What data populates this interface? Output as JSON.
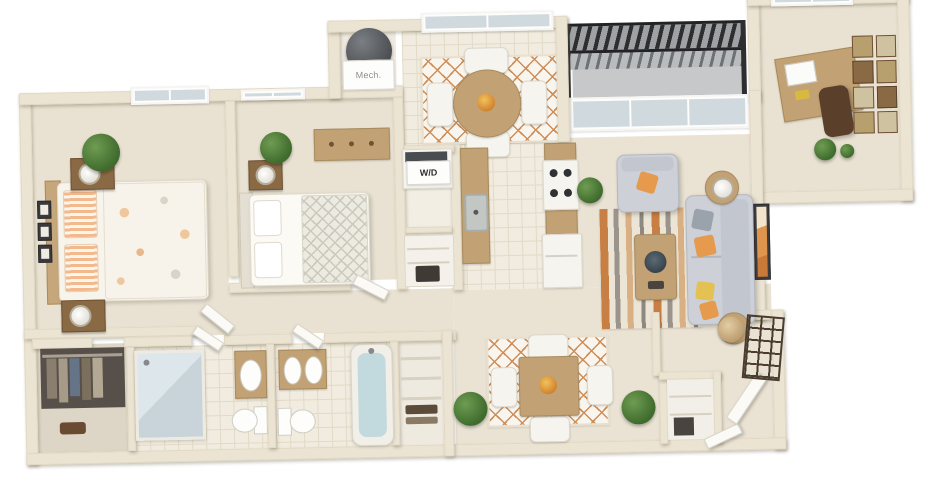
{
  "image_type": "3d-apartment-floor-plan-render",
  "labels": {
    "mech": "Mech.",
    "wd": "W/D"
  },
  "palette": {
    "background": "#ffffff",
    "wall": "#ece4d3",
    "carpet": "#e9e2d2",
    "tile": "#f1ecdf",
    "wood": "#c2a274",
    "dark_wood": "#8a6a44",
    "accent_orange": "#e0934e",
    "sofa_gray": "#cdd0d6",
    "plant_green": "#4e7d3c",
    "railing_dark": "#2e2e30",
    "glass": "#d3dde2",
    "tub_water": "#c2dade"
  },
  "rooms": [
    {
      "name": "master-bedroom",
      "items": [
        "queen bed with floral blanket and striped pillows",
        "two nightstands with lamps",
        "potted plant",
        "three wall frames",
        "window"
      ]
    },
    {
      "name": "bedroom-2",
      "items": [
        "bed with trellis blanket",
        "nightstand with lamp",
        "dresser",
        "potted plant",
        "window"
      ]
    },
    {
      "name": "mechanical-closet",
      "label": "Mech.",
      "items": [
        "water heater"
      ]
    },
    {
      "name": "breakfast-nook",
      "items": [
        "round wood table",
        "four white chairs",
        "lattice rug",
        "fruit bowl",
        "window"
      ]
    },
    {
      "name": "laundry-closet",
      "label": "W/D",
      "items": [
        "stacked washer-dryer",
        "storage shelves"
      ]
    },
    {
      "name": "kitchen",
      "items": [
        "counter with sink",
        "bar counter",
        "stove with four burners",
        "refrigerator"
      ]
    },
    {
      "name": "balcony",
      "items": [
        "slatted railing",
        "sliding glass door"
      ]
    },
    {
      "name": "office-den",
      "items": [
        "desk with laptop",
        "office chair",
        "gallery frame wall",
        "plants",
        "window"
      ]
    },
    {
      "name": "living-room",
      "items": [
        "gray sofa with orange pillows",
        "armchair",
        "coffee table",
        "striped area rug",
        "two side tables with lamps",
        "framed wall art"
      ]
    },
    {
      "name": "dining-area",
      "items": [
        "square wood table",
        "four white chairs",
        "lattice rug",
        "two potted plants"
      ]
    },
    {
      "name": "walk-in-closet",
      "items": [
        "hanging clothes",
        "shoes"
      ]
    },
    {
      "name": "bathroom-1",
      "items": [
        "glass shower",
        "vanity with sink",
        "toilet"
      ]
    },
    {
      "name": "bathroom-2",
      "items": [
        "double vanity",
        "toilet",
        "bathtub"
      ]
    },
    {
      "name": "linen-closet",
      "items": [
        "shelves",
        "towels"
      ]
    },
    {
      "name": "entry",
      "items": [
        "open front door",
        "coat closet",
        "trellis wall decor",
        "basket"
      ]
    }
  ]
}
